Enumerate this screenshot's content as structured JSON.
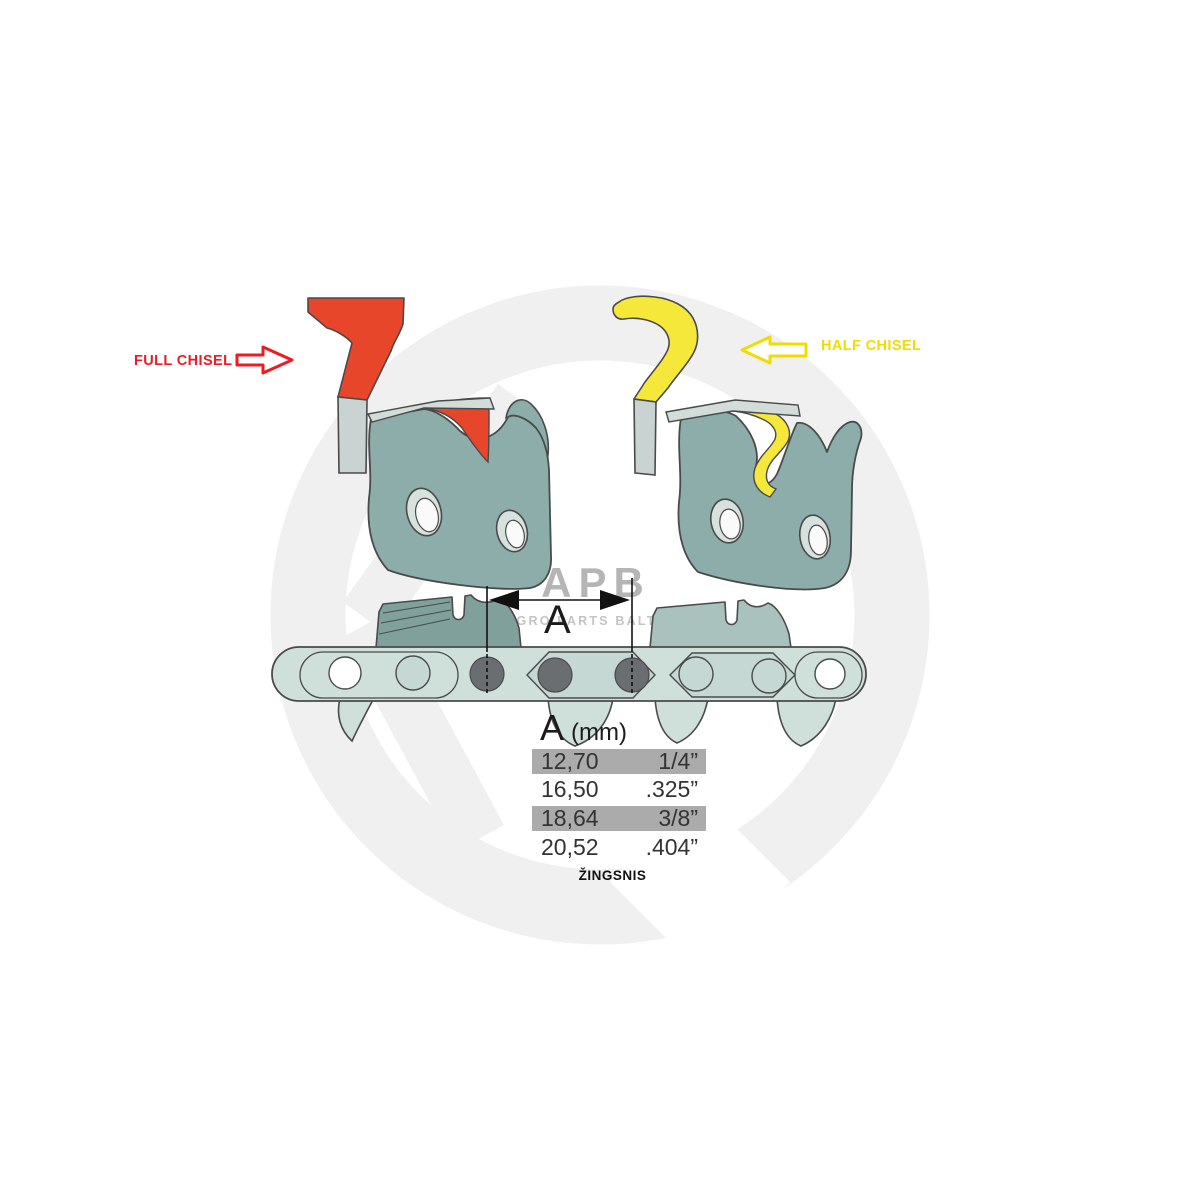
{
  "labels": {
    "full_chisel": "FULL CHISEL",
    "half_chisel": "HALF CHISEL"
  },
  "watermark": {
    "logo": "APB",
    "subtitle": "AGRO PARTS BALTIJA"
  },
  "dimension": {
    "label": "A"
  },
  "table": {
    "header_letter": "A",
    "header_unit": "(mm)",
    "columns": [
      "mm",
      "inch"
    ],
    "rows": [
      {
        "mm": "12,70",
        "inch": "1/4”",
        "highlighted": true
      },
      {
        "mm": "16,50",
        "inch": ".325”",
        "highlighted": false
      },
      {
        "mm": "18,64",
        "inch": "3/8”",
        "highlighted": true
      },
      {
        "mm": "20,52",
        "inch": ".404”",
        "highlighted": false
      }
    ],
    "caption": "ŽINGSNIS"
  },
  "colors": {
    "accent_red": "#e8462b",
    "label_red": "#ec1c24",
    "accent_yellow": "#f5e83b",
    "label_yellow": "#f0dc00",
    "teal_body": "#8cada9",
    "teal_tooth_dark": "#7fa09b",
    "teal_tooth_light": "#a9c2bd",
    "teal_band": "#cfdfda",
    "teal_hexlink": "#c6d8d3",
    "teal_plate": "#d2dcd8",
    "shank_gray": "#c9d3d1",
    "hole_light": "#d7e1dd",
    "rivet": "#6a6e70",
    "outline": "#4a4a4a",
    "row_highlight": "#ababab",
    "watermark": "#f0f0f0",
    "watermark_text": "#b5b5b5",
    "watermark_subtext": "#c4c4c4"
  }
}
